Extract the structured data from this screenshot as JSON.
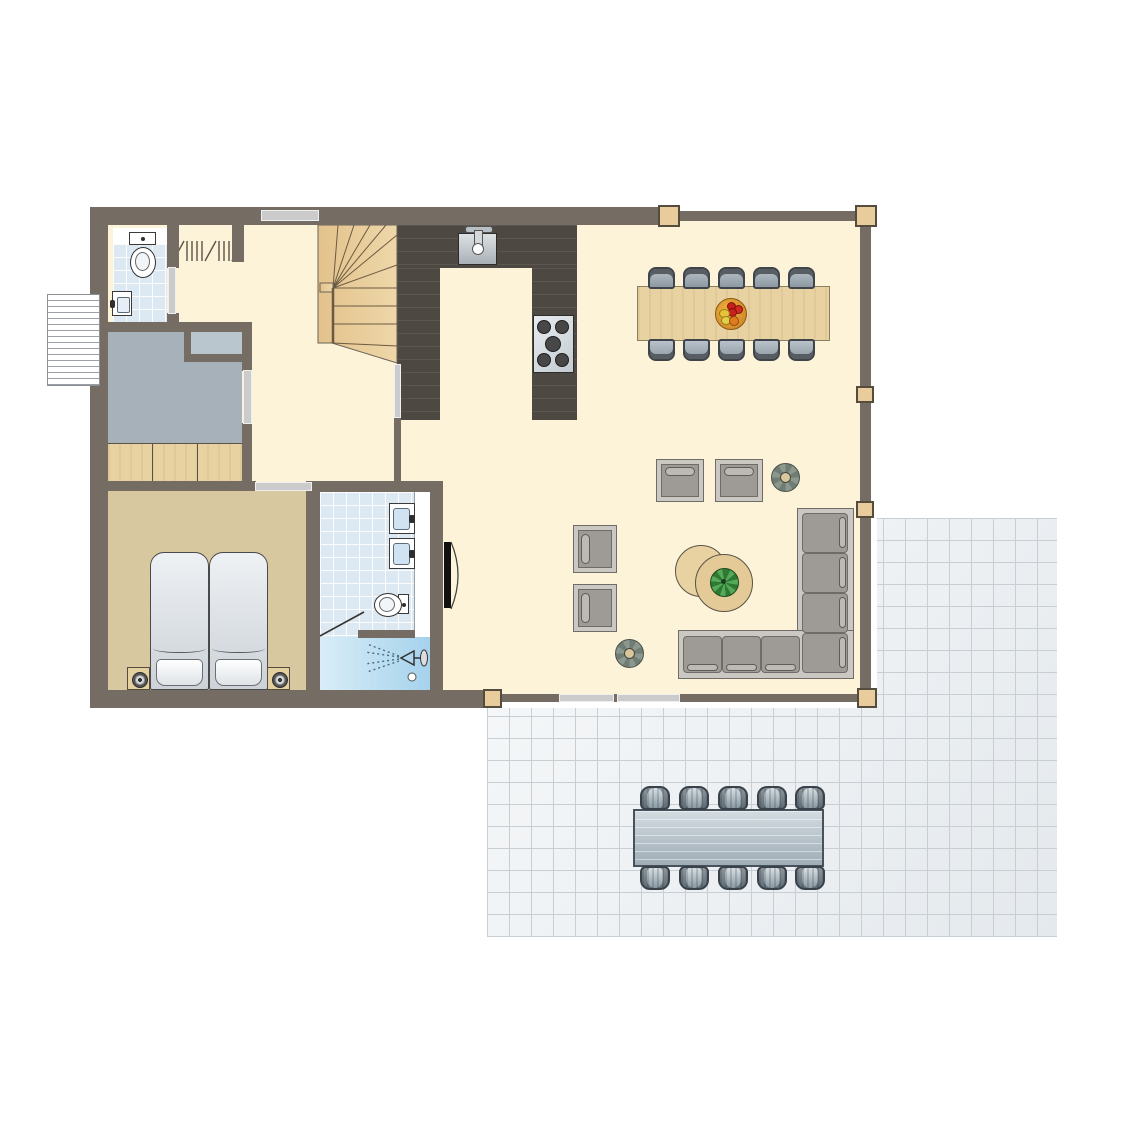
{
  "document": {
    "type": "floor-plan",
    "view": "top-down architectural drawing",
    "text_labels": [],
    "building_shape": "rectangular house with L-shaped tiled terrace at lower right"
  },
  "rooms": [
    {
      "name": "wc",
      "floor": "light-blue tiles",
      "fixtures": [
        "toilet",
        "hand-basin"
      ]
    },
    {
      "name": "hallway",
      "floor": "cream",
      "features": [
        "coat-rack-symbol",
        "winder-staircase",
        "exterior-slatted-structure"
      ]
    },
    {
      "name": "storage-room",
      "floor": "gray",
      "features": [
        "duct-shaft",
        "built-in-wardrobe"
      ]
    },
    {
      "name": "bedroom",
      "floor": "tan",
      "furniture": [
        "single-bed",
        "single-bed",
        "nightstand-with-lamp",
        "nightstand-with-lamp"
      ]
    },
    {
      "name": "bathroom",
      "floor": "light-blue tiles",
      "fixtures": [
        "washbasin",
        "washbasin",
        "toilet",
        "shower",
        "sliding-door"
      ]
    },
    {
      "name": "kitchen",
      "floor": "dark-wood planks",
      "fixtures": [
        "sink-with-faucet",
        "five-burner-hob"
      ]
    },
    {
      "name": "dining-area",
      "furniture": [
        "wooden-dining-table",
        "fruit-bowl"
      ],
      "chairs": 10
    },
    {
      "name": "living-area",
      "furniture": [
        "corner-sofa",
        "armchair",
        "armchair",
        "armchair",
        "armchair",
        "round-side-table",
        "round-side-table-with-plant",
        "potted-plant",
        "potted-plant"
      ],
      "features": [
        "sliding-glass-windows",
        "window-wall-with-posts"
      ]
    },
    {
      "name": "terrace",
      "floor": "tile-grid",
      "furniture": [
        "outdoor-dining-table"
      ],
      "chairs": 10
    }
  ],
  "counts": {
    "dining_chairs": 10,
    "terrace_chairs": 10,
    "beds": 2,
    "armchairs": 4,
    "plants": 3,
    "wood_posts": 6,
    "washbasins_bathroom": 2,
    "hob_burners": 5
  },
  "palette": {
    "wall": "#756c64",
    "floor_cream": "#fdf3d8",
    "kitchen_dark_wood": "#4d4841",
    "bathroom_tile": "#dde9f2",
    "shower_blue": "#a5d2ec",
    "storage_gray": "#a6b1ba",
    "bedroom_tan": "#d8c8a0",
    "light_wood": "#e9d2a2",
    "chair_gray": "#94a0aa",
    "sofa_gray": "#9e9a96",
    "terrace_tile": "#eef1f4",
    "terrace_grid_line": "#c7ced4",
    "post_wood": "#e8cc9b",
    "fruit_red": "#c8201a",
    "fruit_orange": "#e07a1f",
    "fruit_yellow": "#e6c33a",
    "plant_green": "#2f7a33"
  }
}
